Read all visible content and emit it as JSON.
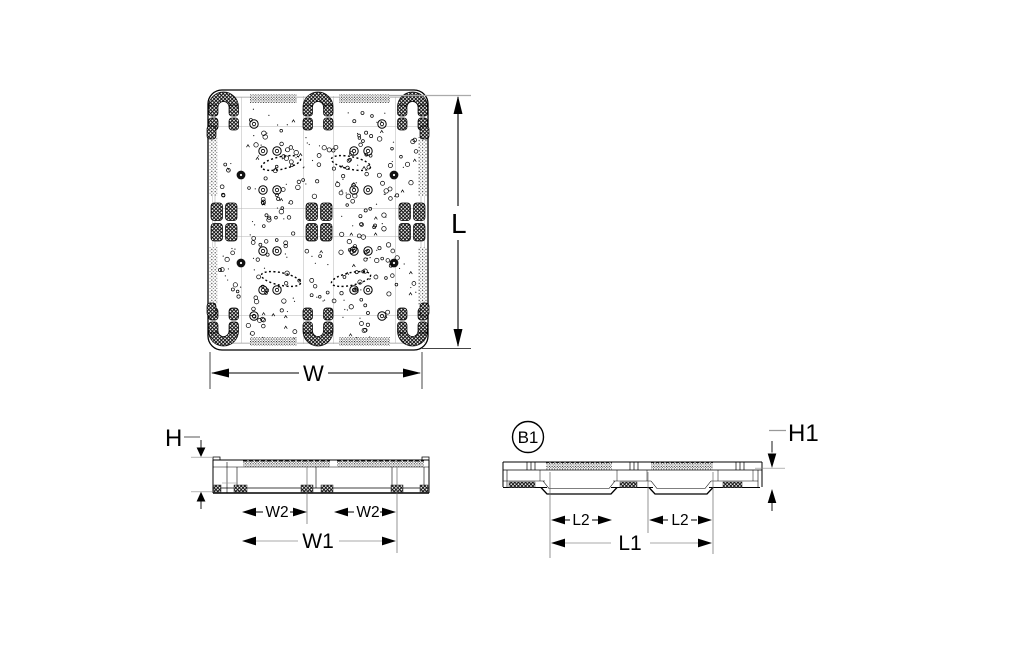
{
  "colors": {
    "ink": "#000000",
    "guide": "#888888",
    "background": "#ffffff"
  },
  "views": {
    "top": {
      "labels": {
        "length": "L",
        "width": "W"
      }
    },
    "front": {
      "labels": {
        "height": "H",
        "opening_width_left": "W2",
        "opening_width_right": "W2",
        "opening_span_width": "W1"
      }
    },
    "side": {
      "labels": {
        "marker": "B1",
        "height": "H1",
        "opening_length_left": "L2",
        "opening_length_right": "L2",
        "opening_span_length": "L1"
      }
    }
  }
}
